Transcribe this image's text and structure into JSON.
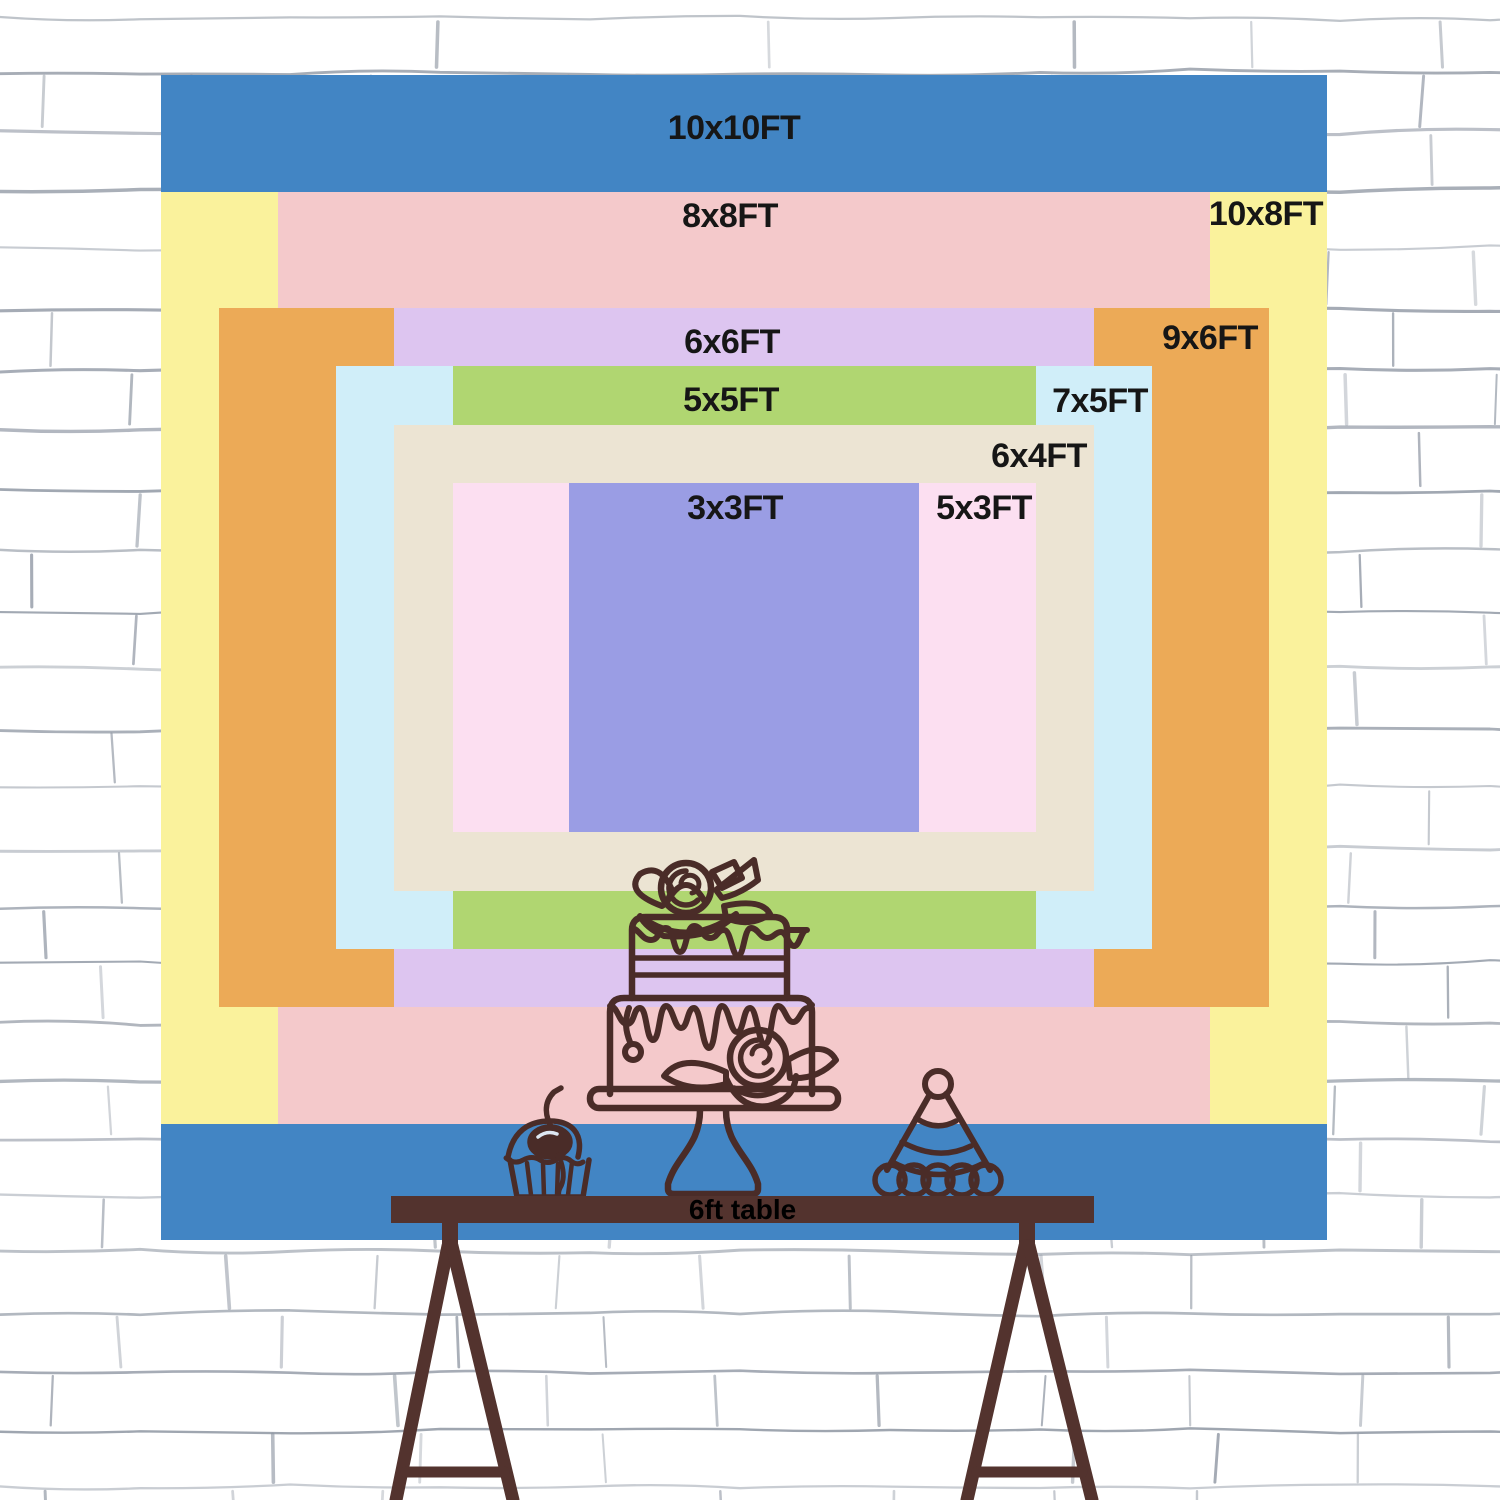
{
  "poster": {
    "width_ft": 10,
    "height_ft": 10,
    "label_color": "#161616",
    "sizes": [
      {
        "id": "10x10",
        "label": "10x10FT",
        "w_ft": 10,
        "h_ft": 10,
        "color": "#4285c4",
        "label_pos": {
          "x": 573,
          "y": 53
        }
      },
      {
        "id": "10x8",
        "label": "10x8FT",
        "w_ft": 10,
        "h_ft": 8,
        "color": "#faf29c",
        "label_pos": {
          "x": 1105,
          "y": 139
        }
      },
      {
        "id": "8x8",
        "label": "8x8FT",
        "w_ft": 8,
        "h_ft": 8,
        "color": "#f4c9cb",
        "label_pos": {
          "x": 569,
          "y": 141
        }
      },
      {
        "id": "9x6",
        "label": "9x6FT",
        "w_ft": 9,
        "h_ft": 6,
        "color": "#ecaa57",
        "label_pos": {
          "x": 1049,
          "y": 263
        }
      },
      {
        "id": "6x6",
        "label": "6x6FT",
        "w_ft": 6,
        "h_ft": 6,
        "color": "#ddc5f0",
        "label_pos": {
          "x": 571,
          "y": 267
        }
      },
      {
        "id": "7x5",
        "label": "7x5FT",
        "w_ft": 7,
        "h_ft": 5,
        "color": "#d0eef9",
        "label_pos": {
          "x": 939,
          "y": 326
        }
      },
      {
        "id": "5x5",
        "label": "5x5FT",
        "w_ft": 5,
        "h_ft": 5,
        "color": "#b0d671",
        "label_pos": {
          "x": 570,
          "y": 325
        }
      },
      {
        "id": "6x4",
        "label": "6x4FT",
        "w_ft": 6,
        "h_ft": 4,
        "color": "#ece4d3",
        "label_pos": {
          "x": 878,
          "y": 381
        }
      },
      {
        "id": "5x3",
        "label": "5x3FT",
        "w_ft": 5,
        "h_ft": 3,
        "color": "#fcdff1",
        "label_pos": {
          "x": 823,
          "y": 433
        }
      },
      {
        "id": "3x3",
        "label": "3x3FT",
        "w_ft": 3,
        "h_ft": 3,
        "color": "#9a9de4",
        "label_pos": {
          "x": 574,
          "y": 433
        }
      }
    ]
  },
  "table": {
    "label": "6ft table",
    "color": "#53332e"
  },
  "decorations": {
    "line_color": "#4a2c28",
    "items": [
      "birthday-cake-on-stand",
      "cupcake-with-cherry",
      "party-hat"
    ]
  },
  "wall": {
    "background": "#ffffff",
    "brick_line_color": "#8e96a2"
  }
}
